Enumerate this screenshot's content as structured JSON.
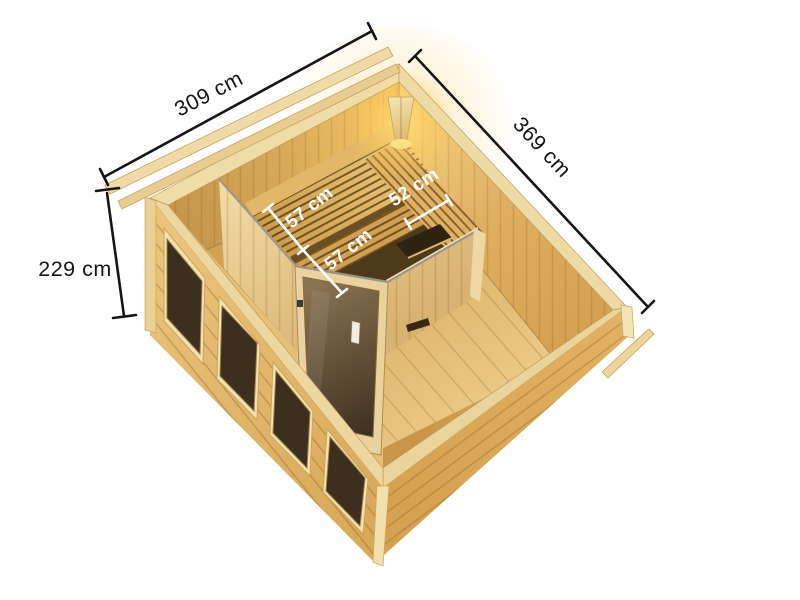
{
  "image": {
    "title": "Sauna cabin 3D top view with dimensions",
    "background": "#ffffff"
  },
  "dimensions": {
    "exterior": {
      "width": {
        "label": "309 cm"
      },
      "depth": {
        "label": "369 cm"
      },
      "height": {
        "label": "229 cm"
      }
    },
    "interior": {
      "bench_upper": {
        "label": "57 cm"
      },
      "bench_lower": {
        "label": "57 cm"
      },
      "bench_side": {
        "label": "52 cm"
      }
    }
  },
  "colors": {
    "background": "#ffffff",
    "dimension_line": "#151515",
    "dimension_text": "#151515",
    "interior_dimension_line": "#ffffff",
    "interior_dimension_text": "#ffffff",
    "wood_light": "#F0DCA6",
    "wood_mid": "#D9A85A",
    "wood_dark": "#6B4E22",
    "glass": "#4E3C25",
    "lamp_glow": "#FFD560"
  }
}
